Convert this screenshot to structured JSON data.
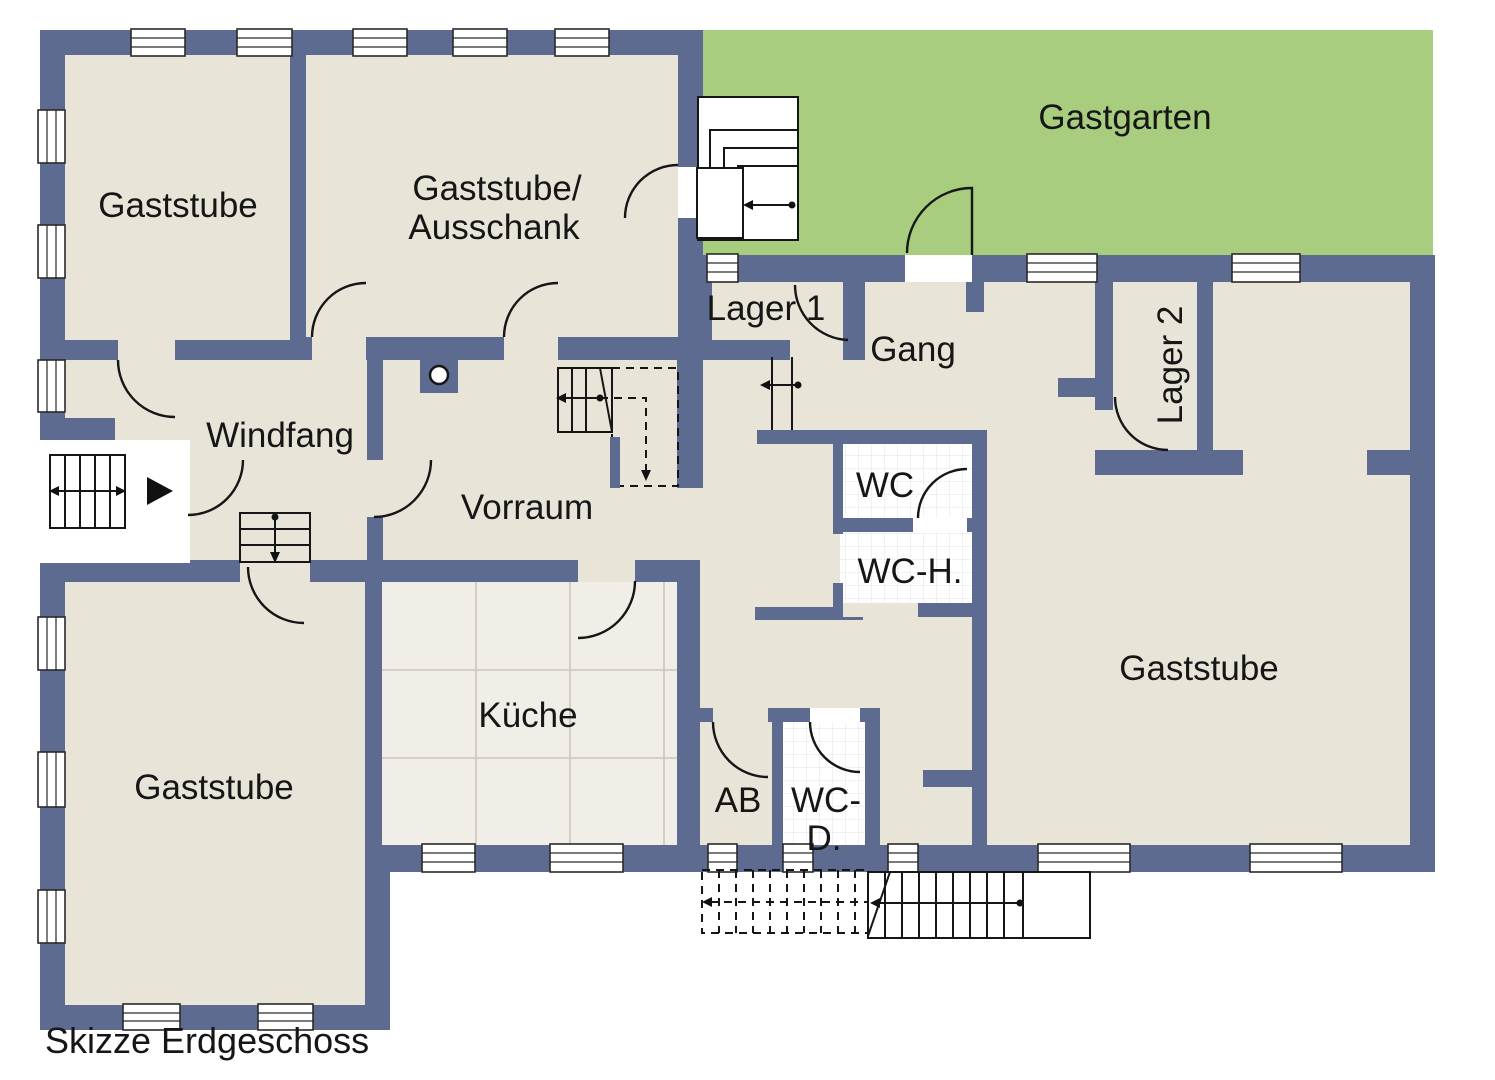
{
  "title": "Skizze Erdgeschoss",
  "colors": {
    "wall": "#5d6b90",
    "floor": "#e8e4d8",
    "garden": "#a8cd7f",
    "kitchen_tile": "#f1eee7",
    "kitchen_tile_line": "#ccc6b8",
    "wc_tile_line": "#dfe3ea"
  },
  "rooms": {
    "gaststube_tl": {
      "label": "Gaststube"
    },
    "gaststube_ausschank": {
      "label_line1": "Gaststube/",
      "label_line2": "Ausschank"
    },
    "gastgarten": {
      "label": "Gastgarten"
    },
    "lager1": {
      "label": "Lager 1"
    },
    "gang": {
      "label": "Gang"
    },
    "lager2": {
      "label": "Lager 2"
    },
    "windfang": {
      "label": "Windfang"
    },
    "vorraum": {
      "label": "Vorraum"
    },
    "wc": {
      "label": "WC"
    },
    "wc_h": {
      "label": "WC-H."
    },
    "kueche": {
      "label": "Küche"
    },
    "gaststube_bl": {
      "label": "Gaststube"
    },
    "ab": {
      "label": "AB"
    },
    "wc_d": {
      "label_line1": "WC-",
      "label_line2": "D."
    },
    "gaststube_r": {
      "label": "Gaststube"
    }
  }
}
